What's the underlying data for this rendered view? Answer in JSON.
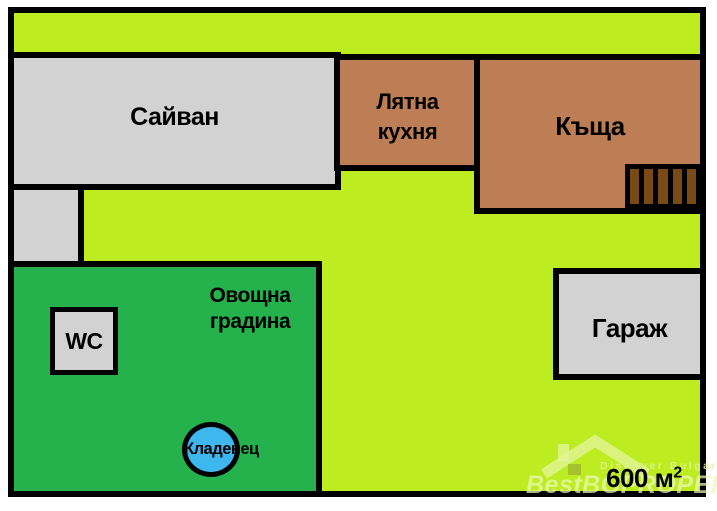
{
  "diagram": {
    "type": "property-plot-plan",
    "area_total": {
      "text": "600 м",
      "superscript": "2"
    },
    "buildings": {
      "sayvan": {
        "label": "Сайван"
      },
      "summer_kitchen": {
        "lines": [
          "Лятна",
          "кухня"
        ]
      },
      "house": {
        "label": "Къща"
      },
      "garage": {
        "label": "Гараж"
      }
    },
    "orchard": {
      "lines": [
        "Овощна",
        "градина"
      ],
      "wc_label": "WC",
      "well_label": "Кладенец"
    },
    "colors": {
      "yard_green": "#bdec20",
      "orchard_green": "#25b24c",
      "building_brown": "#bd7d55",
      "stairs_brown": "#7a4a16",
      "outbuilding_gray": "#d2d2d2",
      "well_blue": "#3eb7ee",
      "outline_black": "#000000",
      "watermark_green": "#d9f277"
    }
  },
  "watermark": {
    "logo": "house-icon",
    "tagline": "Discover Bulgaria",
    "brand_prefix": "BestBG",
    "brand_suffix": "PROPERTIES"
  }
}
